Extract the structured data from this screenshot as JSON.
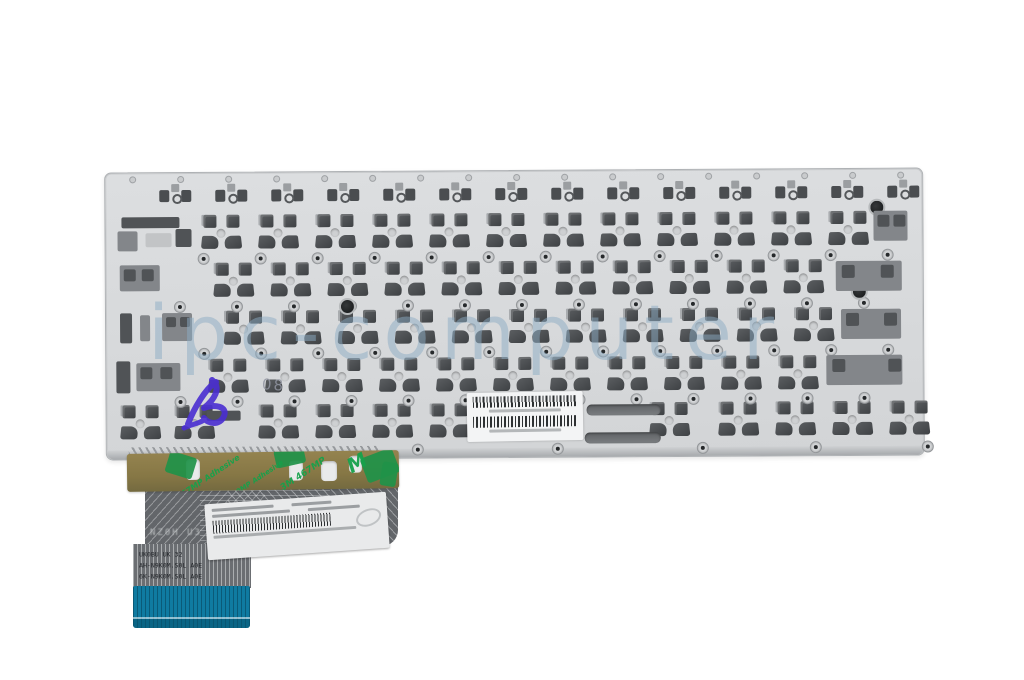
{
  "scene": {
    "description": "Product photo: rear side of a laptop keyboard assembly - silver metal mounting plate with rows of key clip cutouts, screw holes, barcode label, adhesive tape strip and folded ribbon cable with blue connector tab",
    "background_color": "#ffffff"
  },
  "watermark": {
    "text": "ipc-computer",
    "color": "#8cacc4",
    "x": 148,
    "y": 288
  },
  "handwritten": {
    "pen_mark_text": "08",
    "x": 262,
    "y": 376
  },
  "plate": {
    "x": 105,
    "y": 170,
    "width": 817,
    "height": 286,
    "rotation_deg": -0.35,
    "clip_dark": "#4e5154",
    "clip_mid": "#83868a",
    "clip_light": "#c2c4c6",
    "function_row": {
      "y": 11,
      "start_x": 54,
      "pitch": 56,
      "count": 14
    },
    "rows": [
      {
        "y": 42,
        "start_x": 96,
        "pitch": 57,
        "count": 12
      },
      {
        "y": 90,
        "start_x": 108,
        "pitch": 57,
        "count": 11
      },
      {
        "y": 138,
        "start_x": 118,
        "pitch": 57,
        "count": 11
      },
      {
        "y": 186,
        "start_x": 102,
        "pitch": 57,
        "count": 11
      }
    ],
    "bottom_row": {
      "y": 232,
      "xs": [
        14,
        68,
        152,
        209,
        266,
        323,
        543,
        612,
        669,
        726,
        783
      ]
    },
    "screw_rows": [
      {
        "y": 80,
        "start_x": 92,
        "pitch": 57,
        "count": 13
      },
      {
        "y": 128,
        "start_x": 68,
        "pitch": 57,
        "count": 13
      },
      {
        "y": 175,
        "start_x": 92,
        "pitch": 57,
        "count": 13
      },
      {
        "y": 223,
        "start_x": 68,
        "pitch": 57,
        "count": 13
      }
    ],
    "edge_holes_top": {
      "y": 3,
      "start_x": 24,
      "pitch": 48,
      "count": 17
    },
    "edge_holes_bottom": {
      "y": 272,
      "xs": [
        305,
        445,
        590,
        703,
        815
      ]
    },
    "dark_holes": [
      {
        "x": 233,
        "y": 126
      },
      {
        "x": 763,
        "y": 30
      },
      {
        "x": 745,
        "y": 114
      }
    ],
    "extra_cutouts": [
      {
        "x": 16,
        "y": 44,
        "w": 58,
        "h": 11,
        "c": "d"
      },
      {
        "x": 12,
        "y": 58,
        "w": 20,
        "h": 20,
        "c": "m"
      },
      {
        "x": 40,
        "y": 60,
        "w": 26,
        "h": 14,
        "c": "l"
      },
      {
        "x": 70,
        "y": 56,
        "w": 16,
        "h": 18,
        "c": "d"
      },
      {
        "x": 14,
        "y": 92,
        "w": 40,
        "h": 26,
        "c": "m"
      },
      {
        "x": 18,
        "y": 96,
        "w": 12,
        "h": 12,
        "c": "d"
      },
      {
        "x": 36,
        "y": 96,
        "w": 12,
        "h": 12,
        "c": "d"
      },
      {
        "x": 14,
        "y": 140,
        "w": 12,
        "h": 30,
        "c": "d"
      },
      {
        "x": 34,
        "y": 142,
        "w": 10,
        "h": 26,
        "c": "m"
      },
      {
        "x": 56,
        "y": 140,
        "w": 30,
        "h": 28,
        "c": "m"
      },
      {
        "x": 60,
        "y": 144,
        "w": 10,
        "h": 10,
        "c": "d"
      },
      {
        "x": 74,
        "y": 144,
        "w": 10,
        "h": 10,
        "c": "d"
      },
      {
        "x": 10,
        "y": 188,
        "w": 14,
        "h": 32,
        "c": "d"
      },
      {
        "x": 30,
        "y": 190,
        "w": 44,
        "h": 28,
        "c": "m"
      },
      {
        "x": 34,
        "y": 194,
        "w": 12,
        "h": 12,
        "c": "d"
      },
      {
        "x": 54,
        "y": 194,
        "w": 12,
        "h": 12,
        "c": "d"
      },
      {
        "x": 768,
        "y": 42,
        "w": 34,
        "h": 30,
        "c": "m"
      },
      {
        "x": 772,
        "y": 46,
        "w": 12,
        "h": 12,
        "c": "d"
      },
      {
        "x": 788,
        "y": 46,
        "w": 12,
        "h": 12,
        "c": "d"
      },
      {
        "x": 730,
        "y": 92,
        "w": 66,
        "h": 30,
        "c": "m"
      },
      {
        "x": 736,
        "y": 96,
        "w": 13,
        "h": 13,
        "c": "d"
      },
      {
        "x": 775,
        "y": 96,
        "w": 13,
        "h": 13,
        "c": "d"
      },
      {
        "x": 735,
        "y": 140,
        "w": 60,
        "h": 30,
        "c": "m"
      },
      {
        "x": 740,
        "y": 144,
        "w": 13,
        "h": 13,
        "c": "d"
      },
      {
        "x": 778,
        "y": 144,
        "w": 13,
        "h": 13,
        "c": "d"
      },
      {
        "x": 720,
        "y": 186,
        "w": 76,
        "h": 30,
        "c": "m"
      },
      {
        "x": 726,
        "y": 190,
        "w": 13,
        "h": 13,
        "c": "d"
      },
      {
        "x": 782,
        "y": 190,
        "w": 13,
        "h": 13,
        "c": "d"
      },
      {
        "x": 100,
        "y": 238,
        "w": 34,
        "h": 10,
        "c": "d"
      }
    ],
    "spacebar_slots": [
      {
        "x": 480,
        "y": 234,
        "w": 74,
        "h": 11
      },
      {
        "x": 478,
        "y": 262,
        "w": 76,
        "h": 11
      }
    ],
    "contact_strip": {
      "x": 22,
      "y": 274,
      "w": 250,
      "h": 8
    }
  },
  "plate_label": {
    "x": 467,
    "y": 392,
    "width": 104,
    "height": 41,
    "rotation_deg": -1
  },
  "tape": {
    "x": 127,
    "y": 452,
    "width": 272,
    "height": 38,
    "rotation_deg": -0.8,
    "holes": [
      {
        "x": 59,
        "y": 6,
        "w": 14,
        "h": 21
      },
      {
        "x": 162,
        "y": 9,
        "w": 14,
        "h": 20
      },
      {
        "x": 194,
        "y": 10,
        "w": 16,
        "h": 20
      },
      {
        "x": 222,
        "y": 5,
        "w": 13,
        "h": 17
      }
    ],
    "patches": [
      {
        "x": 40,
        "y": 1,
        "w": 28,
        "h": 22,
        "rot": 18
      },
      {
        "x": 148,
        "y": -4,
        "w": 30,
        "h": 18,
        "rot": -12
      },
      {
        "x": 236,
        "y": 2,
        "w": 34,
        "h": 26,
        "rot": -20
      },
      {
        "x": 254,
        "y": 12,
        "w": 16,
        "h": 24,
        "rot": 10
      }
    ],
    "prints": [
      {
        "text": "467MP Adhesive",
        "x": 44,
        "y": 20,
        "rot": -33,
        "size": 8
      },
      {
        "text": "200MP Adhesive",
        "x": 96,
        "y": 24,
        "rot": -33,
        "size": 7
      },
      {
        "text": "3M 467MP",
        "x": 150,
        "y": 18,
        "rot": -33,
        "size": 9
      },
      {
        "text": "M",
        "x": 220,
        "y": 0,
        "rot": -28,
        "size": 20
      }
    ]
  },
  "cable": {
    "body": {
      "x": 145,
      "y": 484,
      "width": 253,
      "height": 62
    },
    "column": {
      "x": 133,
      "y": 544,
      "width": 118,
      "height": 44
    },
    "faint_top_text": "NZ0H U3",
    "print_lines": [
      "UK0BU UK 32",
      "AH-N9K0M.S0L A0E",
      "6K-N9K0M.S0L A0E"
    ],
    "label": {
      "x": 206,
      "y": 498,
      "width": 168,
      "height": 46,
      "rotation_deg": -4
    },
    "tab": {
      "x": 133,
      "y": 586,
      "width": 117,
      "height": 42,
      "color": "#0f7ba1"
    }
  }
}
